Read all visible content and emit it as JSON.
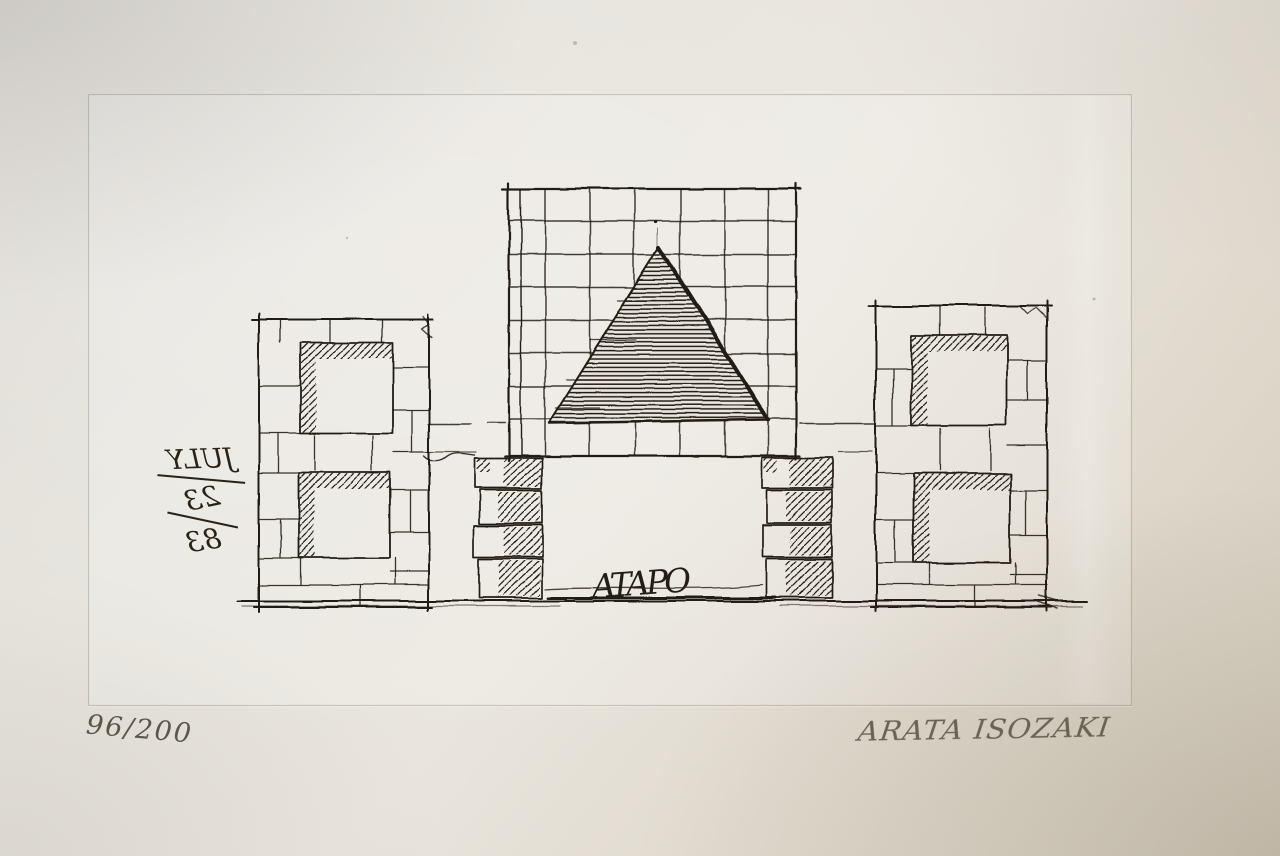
{
  "artwork": {
    "inscriptions": {
      "edition_number": "96/200",
      "artist_signature": "ARATA ISOZAKI",
      "plate_date_full": "JULY 23/83",
      "plate_date_parts": [
        "JULY",
        "23",
        "83"
      ],
      "plate_date_mirrored": true,
      "plate_scribble": "ATAPO"
    },
    "scene": {
      "type": "architectural elevation etching on paper",
      "elements": [
        "central grid facade containing a horizontally hatched pyramid",
        "two stacked-stone piers supporting the grid facade over an opening",
        "left stone pavilion with two square window openings shadow-hatched top and left",
        "right stone pavilion with two square window openings shadow-hatched top and left",
        "ground line",
        "plate mark rectangle"
      ]
    },
    "colors": {
      "paper": "#e7e3db",
      "paper_shadow": "#d4ccbd",
      "plate_area": "#ebe7df",
      "plate_mark_line": "#b5ac9c",
      "ink": "#241d14",
      "pencil": "#5f584d"
    }
  }
}
